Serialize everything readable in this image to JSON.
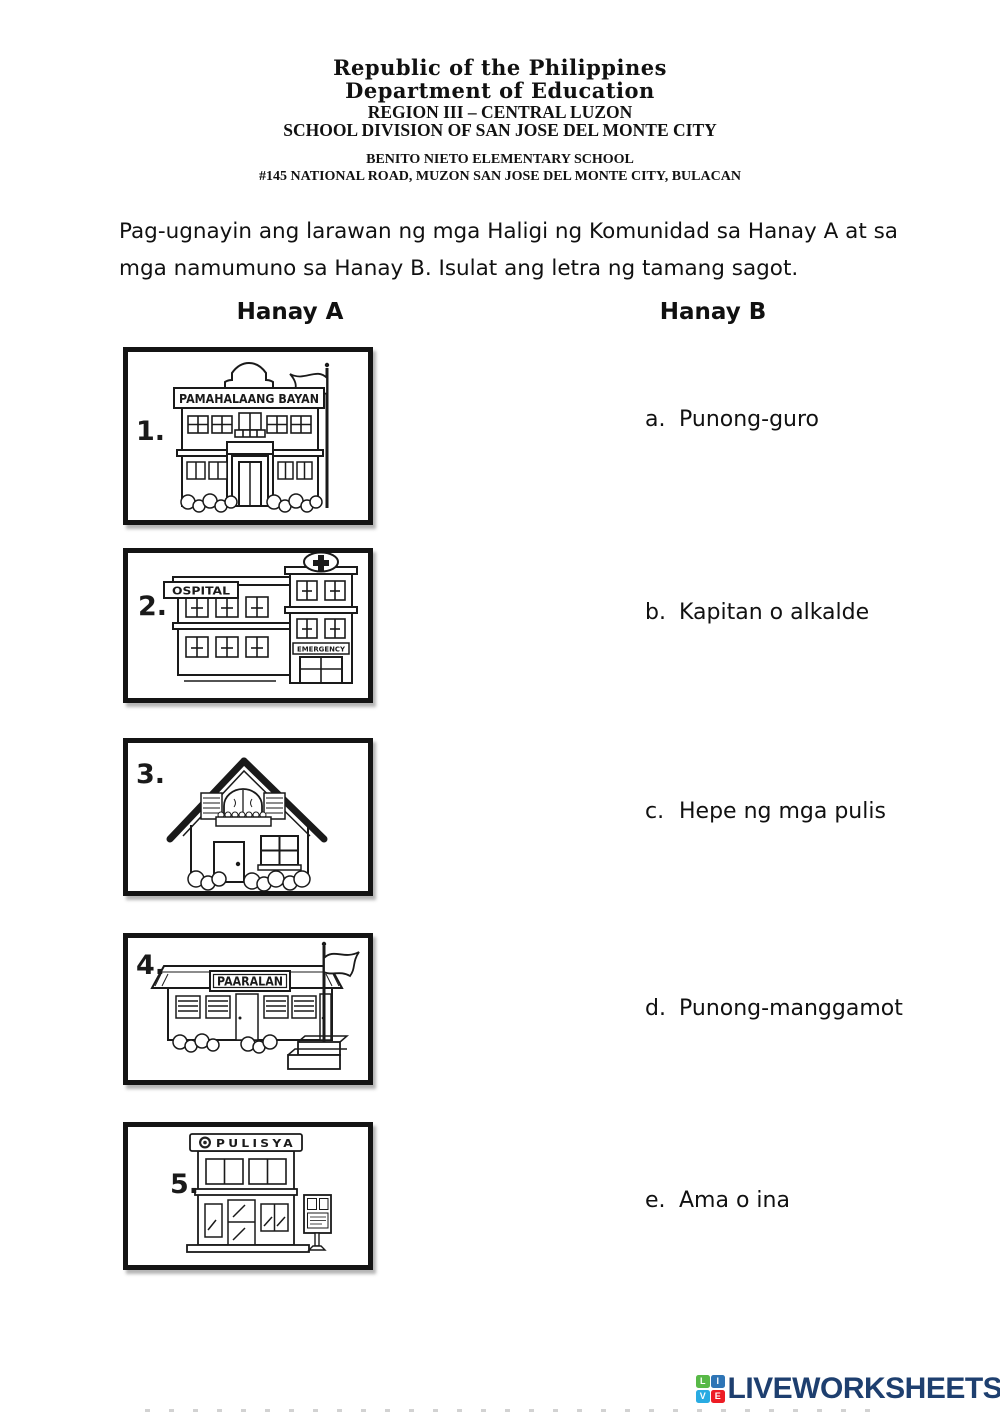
{
  "header": {
    "line1": "Republic of the Philippines",
    "line2": "Department of Education",
    "line3": "REGION III – CENTRAL LUZON",
    "line4": "SCHOOL DIVISION OF SAN JOSE DEL MONTE CITY",
    "line5": "BENITO NIETO ELEMENTARY SCHOOL",
    "line6": "#145 NATIONAL ROAD, MUZON SAN JOSE DEL MONTE CITY, BULACAN"
  },
  "instructions": {
    "line1": "Pag-ugnayin ang larawan ng mga Haligi ng Komunidad sa Hanay A at sa",
    "line2": "mga namumuno sa Hanay B. Isulat ang letra ng tamang sagot."
  },
  "columns": {
    "left": "Hanay A",
    "right": "Hanay B"
  },
  "items": [
    {
      "number": "1.",
      "name": "pamahalaang-bayan",
      "sign": "PAMAHALAANG BAYAN"
    },
    {
      "number": "2.",
      "name": "ospital",
      "sign": "OSPITAL",
      "sign2": "EMERGENCY"
    },
    {
      "number": "3.",
      "name": "bahay"
    },
    {
      "number": "4.",
      "name": "paaralan",
      "sign": "PAARALAN"
    },
    {
      "number": "5.",
      "name": "pulisya",
      "sign": "PULISYA"
    }
  ],
  "answers": [
    {
      "letter": "a.",
      "text": "Punong-guro"
    },
    {
      "letter": "b.",
      "text": "Kapitan o alkalde"
    },
    {
      "letter": "c.",
      "text": "Hepe ng mga pulis"
    },
    {
      "letter": "d.",
      "text": "Punong-manggamot"
    },
    {
      "letter": "e.",
      "text": "Ama o ina"
    }
  ],
  "footer": {
    "logo_text": "LIVEWORKSHEETS",
    "tiles": [
      "L",
      "I",
      "V",
      "E"
    ],
    "colors": {
      "text": "#1e3f6f",
      "tile_l": "#58b947",
      "tile_i": "#2e75b6",
      "tile_v": "#29abe2",
      "tile_e": "#ed1c24"
    }
  }
}
